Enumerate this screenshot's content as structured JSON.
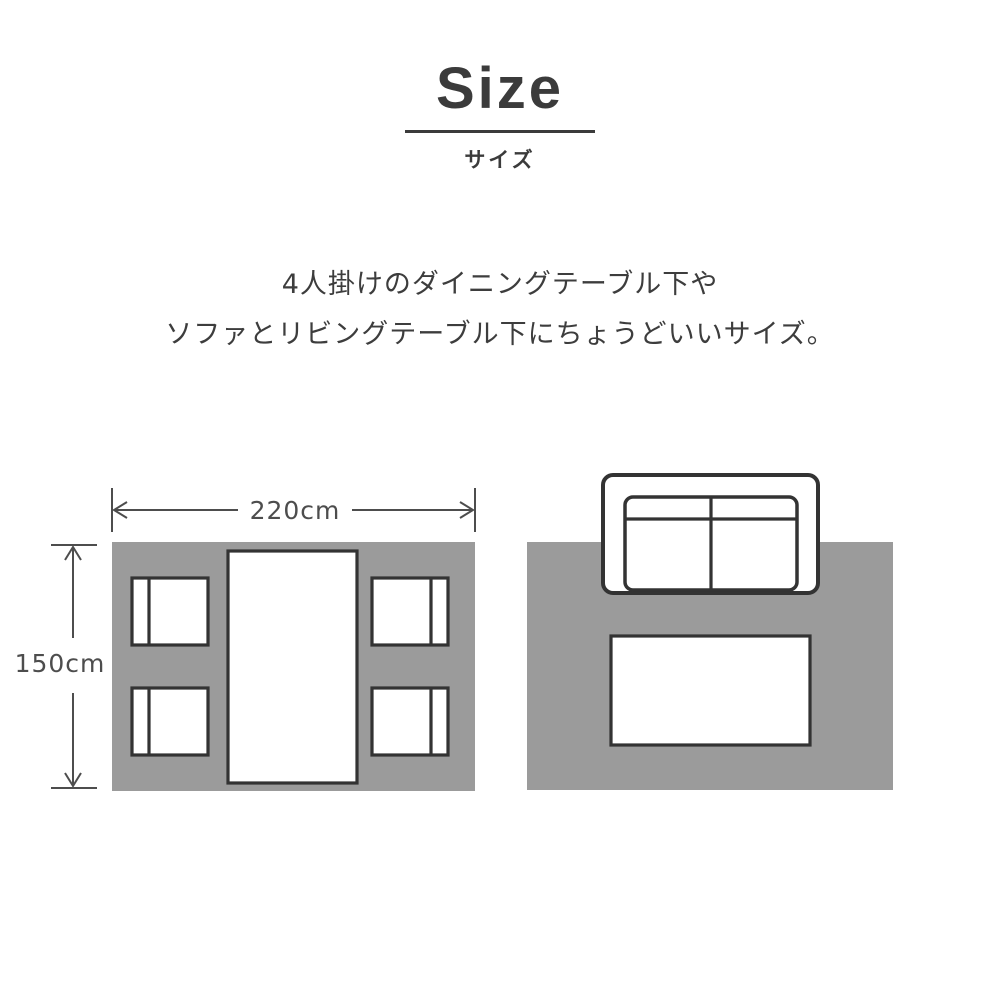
{
  "header": {
    "title": "Size",
    "subtitle": "サイズ"
  },
  "description": {
    "line1": "4人掛けのダイニングテーブル下や",
    "line2": "ソファとリビングテーブル下にちょうどいいサイズ。"
  },
  "diagrams": {
    "dining": {
      "width_label": "220cm",
      "height_label": "150cm"
    }
  },
  "colors": {
    "rug": "#9b9b9b",
    "furniture_outline": "#333333",
    "dimension": "#4d4d4d",
    "heading": "#3b3b3b",
    "body_text": "#3d3d3d",
    "background": "#ffffff"
  }
}
